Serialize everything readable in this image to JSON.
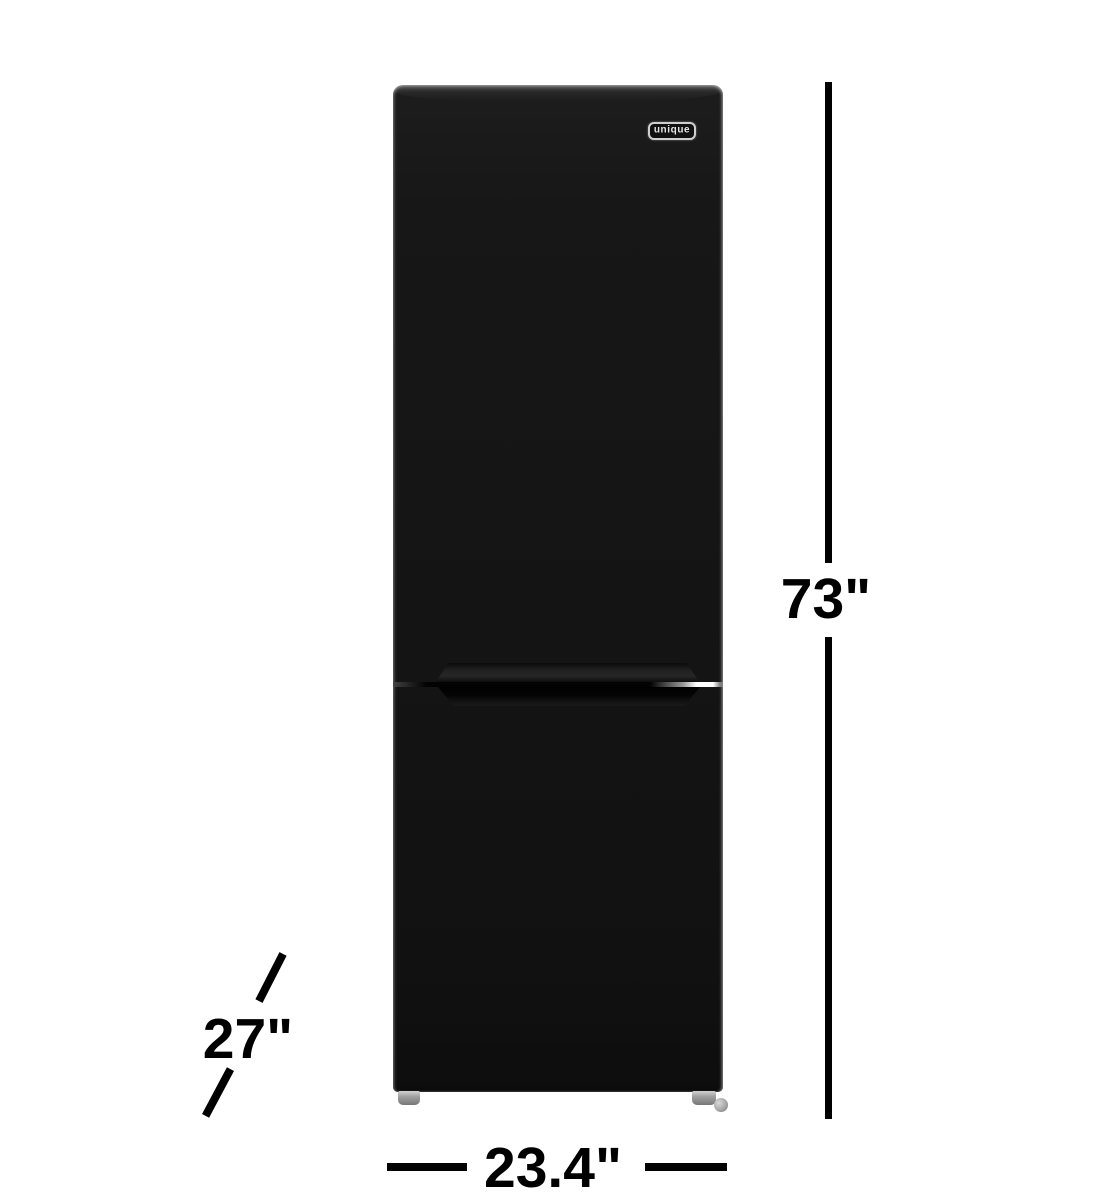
{
  "figure": {
    "description": "black two-door bottom-freezer refrigerator, front view, with dimension callouts"
  },
  "brand": {
    "logo_text": "unique"
  },
  "dimensions": {
    "height": {
      "label": "73\"",
      "orientation": "vertical",
      "side": "right"
    },
    "width": {
      "label": "23.4\"",
      "orientation": "horizontal",
      "side": "bottom"
    },
    "depth": {
      "label": "27\"",
      "orientation": "diagonal",
      "side": "bottom-left"
    }
  },
  "colors": {
    "background": "#ffffff",
    "fridge_black": "#151515",
    "dimension_ink": "#000000",
    "foot_metal": "#a8a8a8",
    "logo_frame": "#cfcfcf"
  }
}
